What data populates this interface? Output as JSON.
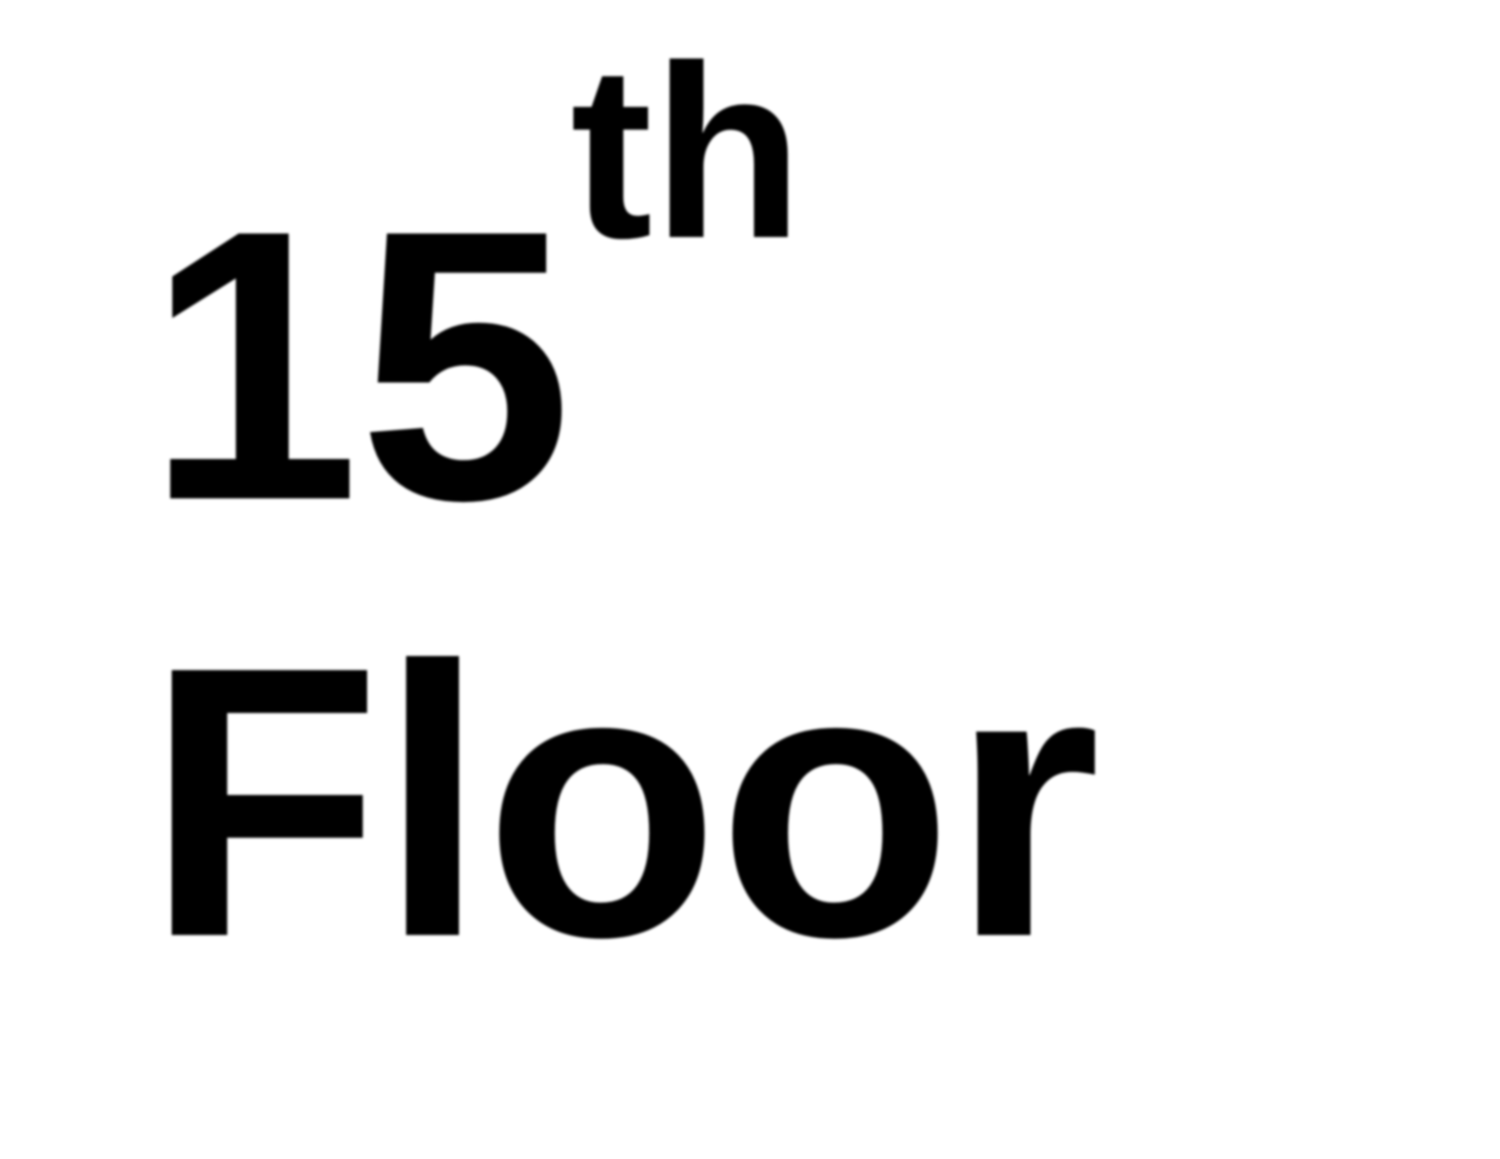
{
  "sign": {
    "floor_number": "15",
    "ordinal_suffix": "th",
    "floor_word": "Floor",
    "full_text": "15th Floor",
    "text_color": "#000000",
    "background_color": "#ffffff"
  }
}
